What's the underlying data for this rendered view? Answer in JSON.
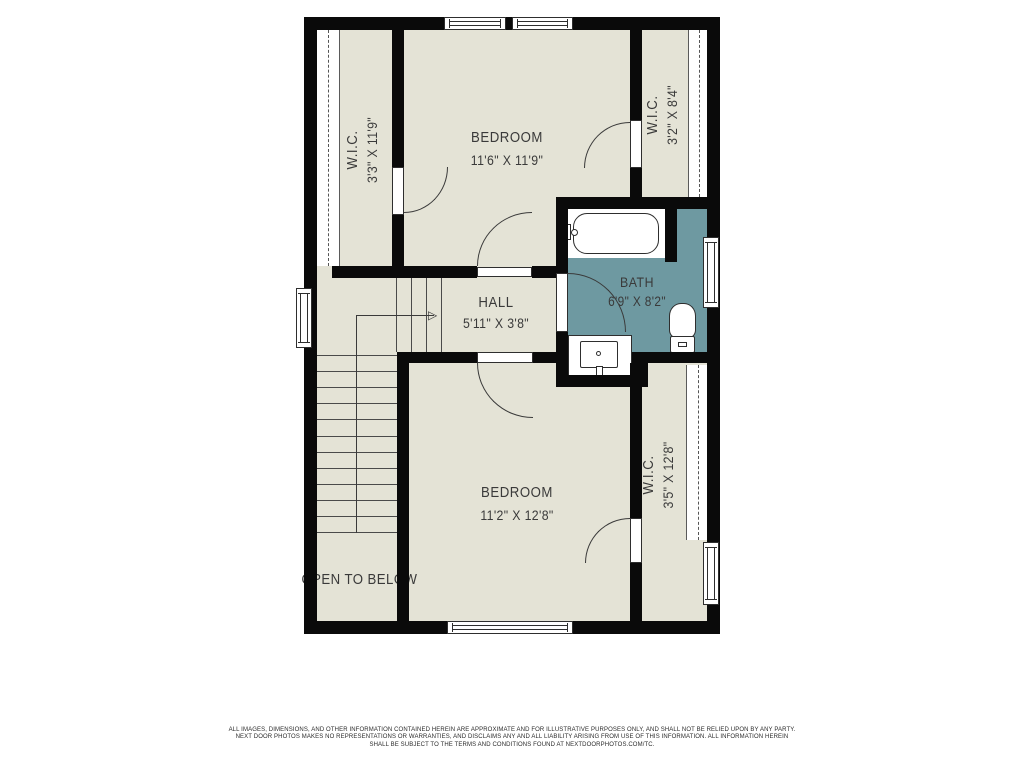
{
  "floor_plan": {
    "rooms": {
      "wic_top_left": {
        "name": "W.I.C.",
        "dims": "3'3\" X 11'9\""
      },
      "bedroom_top": {
        "name": "BEDROOM",
        "dims": "11'6\" X 11'9\""
      },
      "wic_top_right": {
        "name": "W.I.C.",
        "dims": "3'2\" X 8'4\""
      },
      "bath": {
        "name": "BATH",
        "dims": "6'9\" X 8'2\""
      },
      "hall": {
        "name": "HALL",
        "dims": "5'11\" X 3'8\""
      },
      "bedroom_bottom": {
        "name": "BEDROOM",
        "dims": "11'2\" X 12'8\""
      },
      "wic_bottom_right": {
        "name": "W.I.C.",
        "dims": "3'5\" X 12'8\""
      }
    },
    "annotations": {
      "open_to_below": "OPEN TO BELOW",
      "stair_arrow_glyph": "▷"
    },
    "colors": {
      "floor": "#E4E3D6",
      "bath_floor": "#6E99A1",
      "wall": "#0A0A0A",
      "line": "#3A3A3A",
      "fixture": "#FFFFFF"
    }
  },
  "footer": {
    "disclaimer_lines": [
      "ALL IMAGES, DIMENSIONS, AND OTHER INFORMATION CONTAINED HEREIN ARE APPROXIMATE AND FOR ILLUSTRATIVE PURPOSES ONLY, AND SHALL NOT BE RELIED UPON BY ANY PARTY.",
      "NEXT DOOR PHOTOS MAKES NO REPRESENTATIONS OR WARRANTIES, AND DISCLAIMS ANY AND ALL LIABILITY ARISING FROM USE OF THIS INFORMATION. ALL INFORMATION HEREIN",
      "SHALL BE SUBJECT TO THE TERMS AND CONDITIONS FOUND AT NEXTDOORPHOTOS.COM/TC."
    ]
  }
}
